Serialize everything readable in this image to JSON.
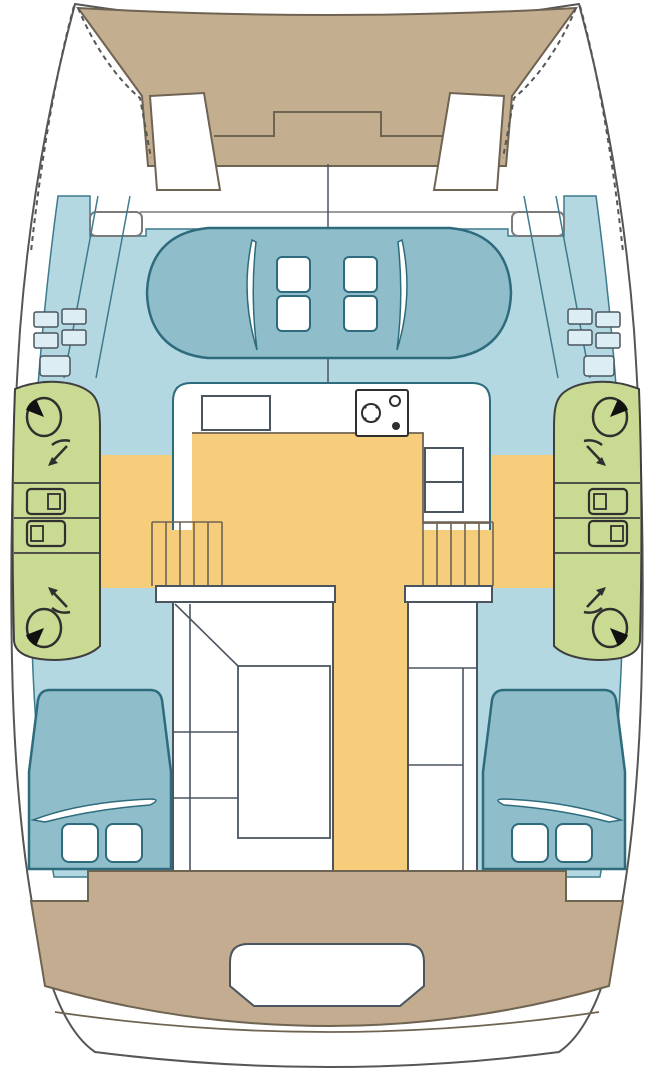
{
  "meta": {
    "title": "Catamaran interior deck plan",
    "type": "boat-floor-plan",
    "orientation": "bow-up",
    "hulls": 2
  },
  "palette": {
    "background": "#ffffff",
    "white": "#ffffff",
    "hull_outline": "#565656",
    "structure_line": "#6f6352",
    "deck_blue": "#b4d8e2",
    "deck_line": "#3d7b8c",
    "cushion_teal": "#8fbeca",
    "teal_outline": "#2e6b7d",
    "trampoline_tan": "#c4ae90",
    "cockpit_tan": "#c3ac8f",
    "bathroom_green": "#c9da92",
    "green_outline": "#3f3f3f",
    "floor_yellow": "#f6ce7b",
    "furniture_line": "#4a5560",
    "fixture_line": "#2f2f2f",
    "fixture_black": "#111111",
    "tread_fill": "#dceef3",
    "seat_line": "#7a7a7a"
  },
  "regions": {
    "bow": {
      "trampoline": 1,
      "bow_seats": 2
    },
    "foredeck": {
      "deck_boxes": 2,
      "crossbeam_step": 1
    },
    "forward_cockpit": {
      "cushion_pads": 1,
      "hatches": 4,
      "bolster_cushions": 2
    },
    "salon": {
      "galley_sink": 1,
      "stove": 1,
      "stove_burners": 3,
      "refrigerator_compartments": 2
    },
    "floor": {
      "salon_floor": 1,
      "athwartship_band": 1,
      "center_corridor": 1
    },
    "heads_port": {
      "toilets": 2,
      "showers": 2,
      "sinks": 2
    },
    "heads_starboard": {
      "toilets": 2,
      "showers": 2,
      "sinks": 2
    },
    "stairs": {
      "port_steps": 5,
      "starboard_steps": 5
    },
    "hull_berths": {
      "port": 1,
      "starboard": 1
    },
    "aft_cabins": {
      "port_pillows": 2,
      "starboard_pillows": 2,
      "berths": 2
    },
    "stern": {
      "cockpit_bench": 1,
      "cockpit_opening": 1,
      "swim_platform": 1
    },
    "side_decks": {
      "walkways": 2,
      "step_treads": 10
    }
  }
}
